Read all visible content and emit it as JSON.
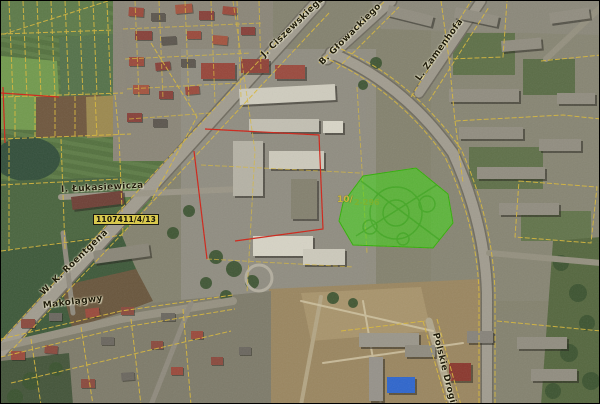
{
  "map": {
    "description": "Aerial orthophoto map view with cadastral parcel overlay and highlighted parcel",
    "colors": {
      "highlight_green": "#3cdc10",
      "highlight_green_stroke": "#2fae0b",
      "cadastral_yellow": "#d9b83a",
      "boundary_red": "#cf2418",
      "parcel_label_bg": "#d9c94e"
    },
    "street_labels": [
      {
        "id": "ciszewskiego",
        "text": "J. Ciszewskiego",
        "x": 262,
        "y": 50,
        "rot": -44
      },
      {
        "id": "glowackiego",
        "text": "B. Głowackiego",
        "x": 320,
        "y": 58,
        "rot": -45
      },
      {
        "id": "zamenhofa",
        "text": "L. Zamenhofa",
        "x": 417,
        "y": 74,
        "rot": -54
      },
      {
        "id": "lukasiewicza",
        "text": "I. Łukasiewicza",
        "x": 60,
        "y": 184,
        "rot": -3
      },
      {
        "id": "roentgena",
        "text": "W. K. Roentgena",
        "x": 41,
        "y": 288,
        "rot": -44
      },
      {
        "id": "makolagwy",
        "text": "Makolągwy",
        "x": 42,
        "y": 300,
        "rot": -7
      },
      {
        "id": "polskie-drogi",
        "text": "Polskie Drogi",
        "x": 434,
        "y": 327,
        "rot": 76
      }
    ],
    "parcel_label": {
      "text": "1107411/4/13"
    },
    "area_labels": [
      {
        "text": "10/"
      },
      {
        "text": "2-296"
      }
    ]
  }
}
